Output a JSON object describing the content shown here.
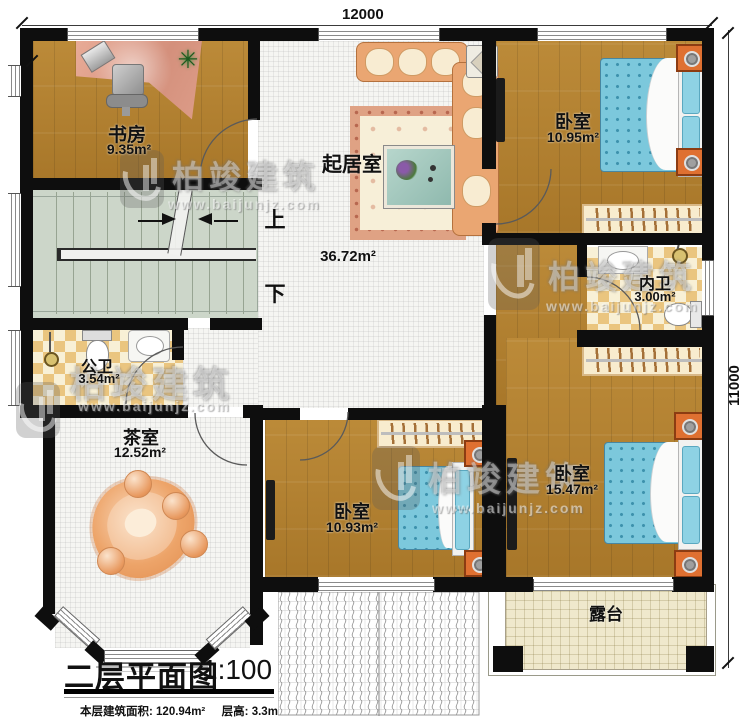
{
  "dimensions": {
    "width_label": "12000",
    "height_label": "11000"
  },
  "rooms": {
    "study": {
      "name": "书房",
      "area": "9.35m²"
    },
    "living": {
      "name": "起居室",
      "area": "36.72m²"
    },
    "bedroom_top": {
      "name": "卧室",
      "area": "10.95m²"
    },
    "bath_inner": {
      "name": "内卫",
      "area": "3.00m²"
    },
    "bath_public": {
      "name": "公卫",
      "area": "3.54m²"
    },
    "tearoom": {
      "name": "茶室",
      "area": "12.52m²"
    },
    "bedroom_bottom": {
      "name": "卧室",
      "area": "10.93m²"
    },
    "bedroom_right": {
      "name": "卧室",
      "area": "15.47m²"
    },
    "terrace": {
      "name": "露台"
    }
  },
  "stairs": {
    "up": "上",
    "down": "下"
  },
  "watermark": {
    "brand": "柏竣建筑",
    "url": "www.baijunjz.com"
  },
  "title": {
    "name": "二层平面图",
    "scale": "1:100"
  },
  "footer": {
    "area_label": "本层建筑面积: ",
    "area_value": "120.94m²",
    "height_label": "层高: ",
    "height_value": "3.3m"
  }
}
